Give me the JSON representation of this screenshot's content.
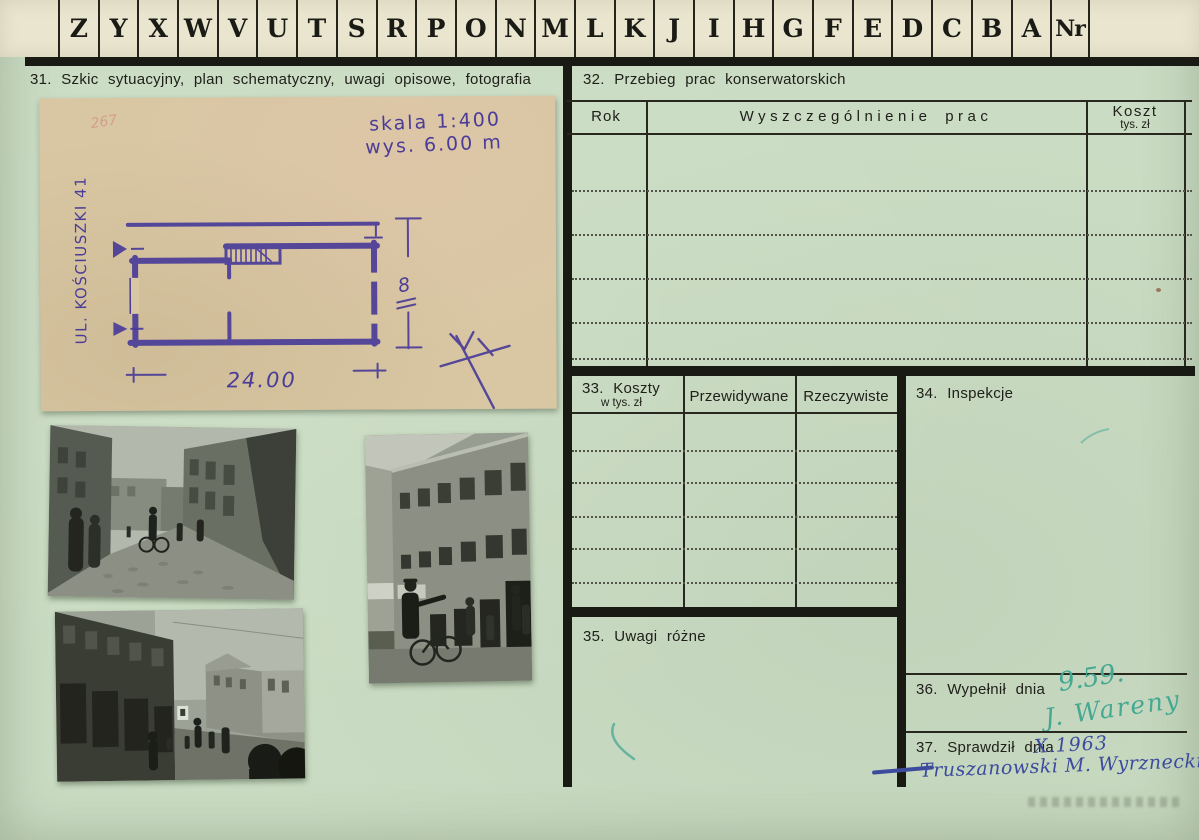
{
  "strip": {
    "letters": [
      "Z",
      "Y",
      "X",
      "W",
      "V",
      "U",
      "T",
      "S",
      "R",
      "P",
      "O",
      "N",
      "M",
      "L",
      "K",
      "J",
      "I",
      "H",
      "G",
      "F",
      "E",
      "D",
      "C",
      "B",
      "A"
    ],
    "nr": "Nr"
  },
  "s31": {
    "title": "31. Szkic sytuacyjny, plan schematyczny, uwagi opisowe, fotografia"
  },
  "sketch": {
    "pencil_number": "267",
    "scale_line1": "skala 1:400",
    "scale_line2": "wys.  6.00 m",
    "street_label": "UL. KOŚCIUSZKI 41",
    "dim_width": "24.00",
    "dim_height": "8",
    "ink_color": "#4a3c98",
    "paper_color": "#d9c7a3"
  },
  "s32": {
    "title": "32. Przebieg prac konserwatorskich",
    "col_rok": "Rok",
    "col_prace": "Wyszczególnienie prac",
    "col_koszt": "Koszt",
    "col_koszt_sub": "tys. zł"
  },
  "s33": {
    "title_line1": "33. Koszty",
    "title_line2": "w tys. zł",
    "col_przewidywane": "Przewidywane",
    "col_rzeczywiste": "Rzeczywiste"
  },
  "s34": {
    "title": "34. Inspekcje"
  },
  "s35": {
    "title": "35. Uwagi różne"
  },
  "s36": {
    "title": "36. Wypełnił dnia",
    "handwritten_date": "9.59.",
    "handwritten_signature": "J. Wareny"
  },
  "s37": {
    "title": "37. Sprawdził dnia",
    "handwritten_date": "X.1963",
    "handwritten_signature": "Truszanowski M. Wyrznecki"
  },
  "photos": [
    {
      "description": "cobbled street with tenement houses and pedestrians"
    },
    {
      "description": "street with dark shopfronts and walking figures"
    },
    {
      "description": "tenement facade with policeman and bicycle"
    }
  ],
  "colors": {
    "card_green": "#cadcc3",
    "strip_cream": "#e9e5cf",
    "ink_purple": "#4a3c98",
    "signature_teal": "#45a893",
    "signature_blue": "#3d4b9e",
    "line_black": "#1a1a14"
  }
}
